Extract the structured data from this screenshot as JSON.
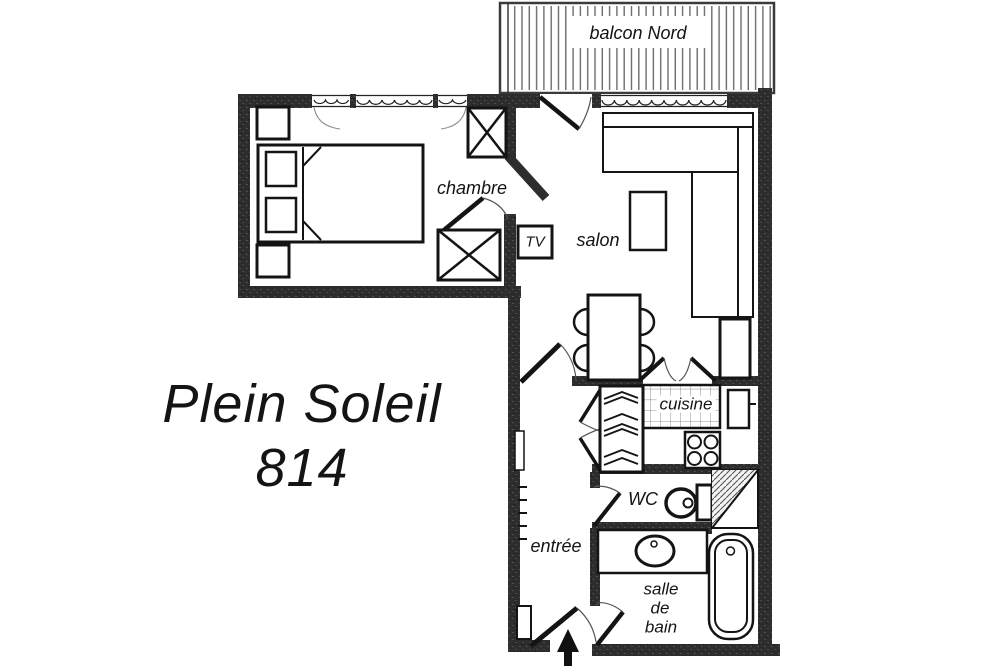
{
  "plan": {
    "resort_name": "Plein Soleil",
    "unit_number": "814",
    "labels": {
      "balcony": "balcon Nord",
      "bedroom": "chambre",
      "living_room": "salon",
      "tv": "TV",
      "kitchen": "cuisine",
      "wc": "WC",
      "entry": "entrée",
      "bathroom": [
        "salle",
        "de",
        "bain"
      ]
    },
    "colors": {
      "wall": "#2d2d2d",
      "line": "#141414",
      "background": "#ffffff"
    }
  }
}
